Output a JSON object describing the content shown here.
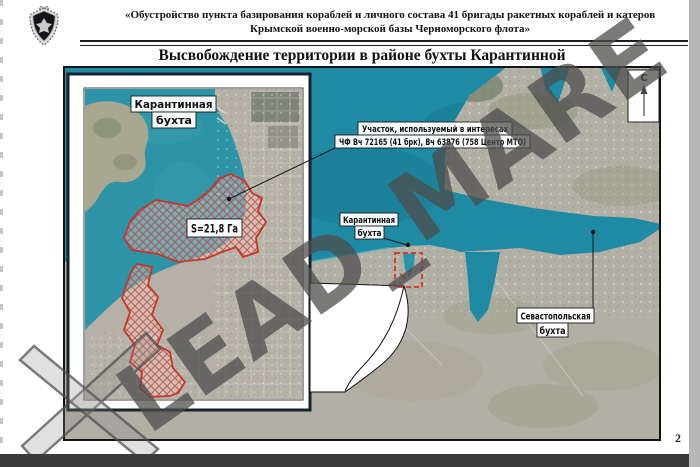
{
  "page": {
    "number": "2"
  },
  "header": {
    "line1": "«Обустройство пункта базирования кораблей и личного состава 41 бригады ракетных кораблей и катеров",
    "line2": "Крымской военно-морской базы Черноморского флота»",
    "title": "Высвобождение территории в районе бухты Карантинной"
  },
  "watermark": {
    "text": "LEAD_MARE"
  },
  "compass": {
    "north_label": "С"
  },
  "inset_map": {
    "bay_label_line1": "Карантинная",
    "bay_label_line2": "бухта",
    "area_label": "S=21,8 Га"
  },
  "main_map": {
    "plot_label_line1": "Участок, используемый в интересах",
    "plot_label_line2": "ЧФ Вч 72165 (41 брк), Вч 63876 (758 Центр МТО)",
    "karantinnaya_label_line1": "Карантинная",
    "karantinnaya_label_line2": "бухта",
    "sevastopol_label_line1": "Севастопольская",
    "sevastopol_label_line2": "бухта"
  },
  "colors": {
    "sea_water": "#1f8aa4",
    "inset_water": "#2d93a6",
    "land": "#b2afa5",
    "highlight_red": "#c8352a",
    "watermark_gray": "#4d4d4b"
  }
}
